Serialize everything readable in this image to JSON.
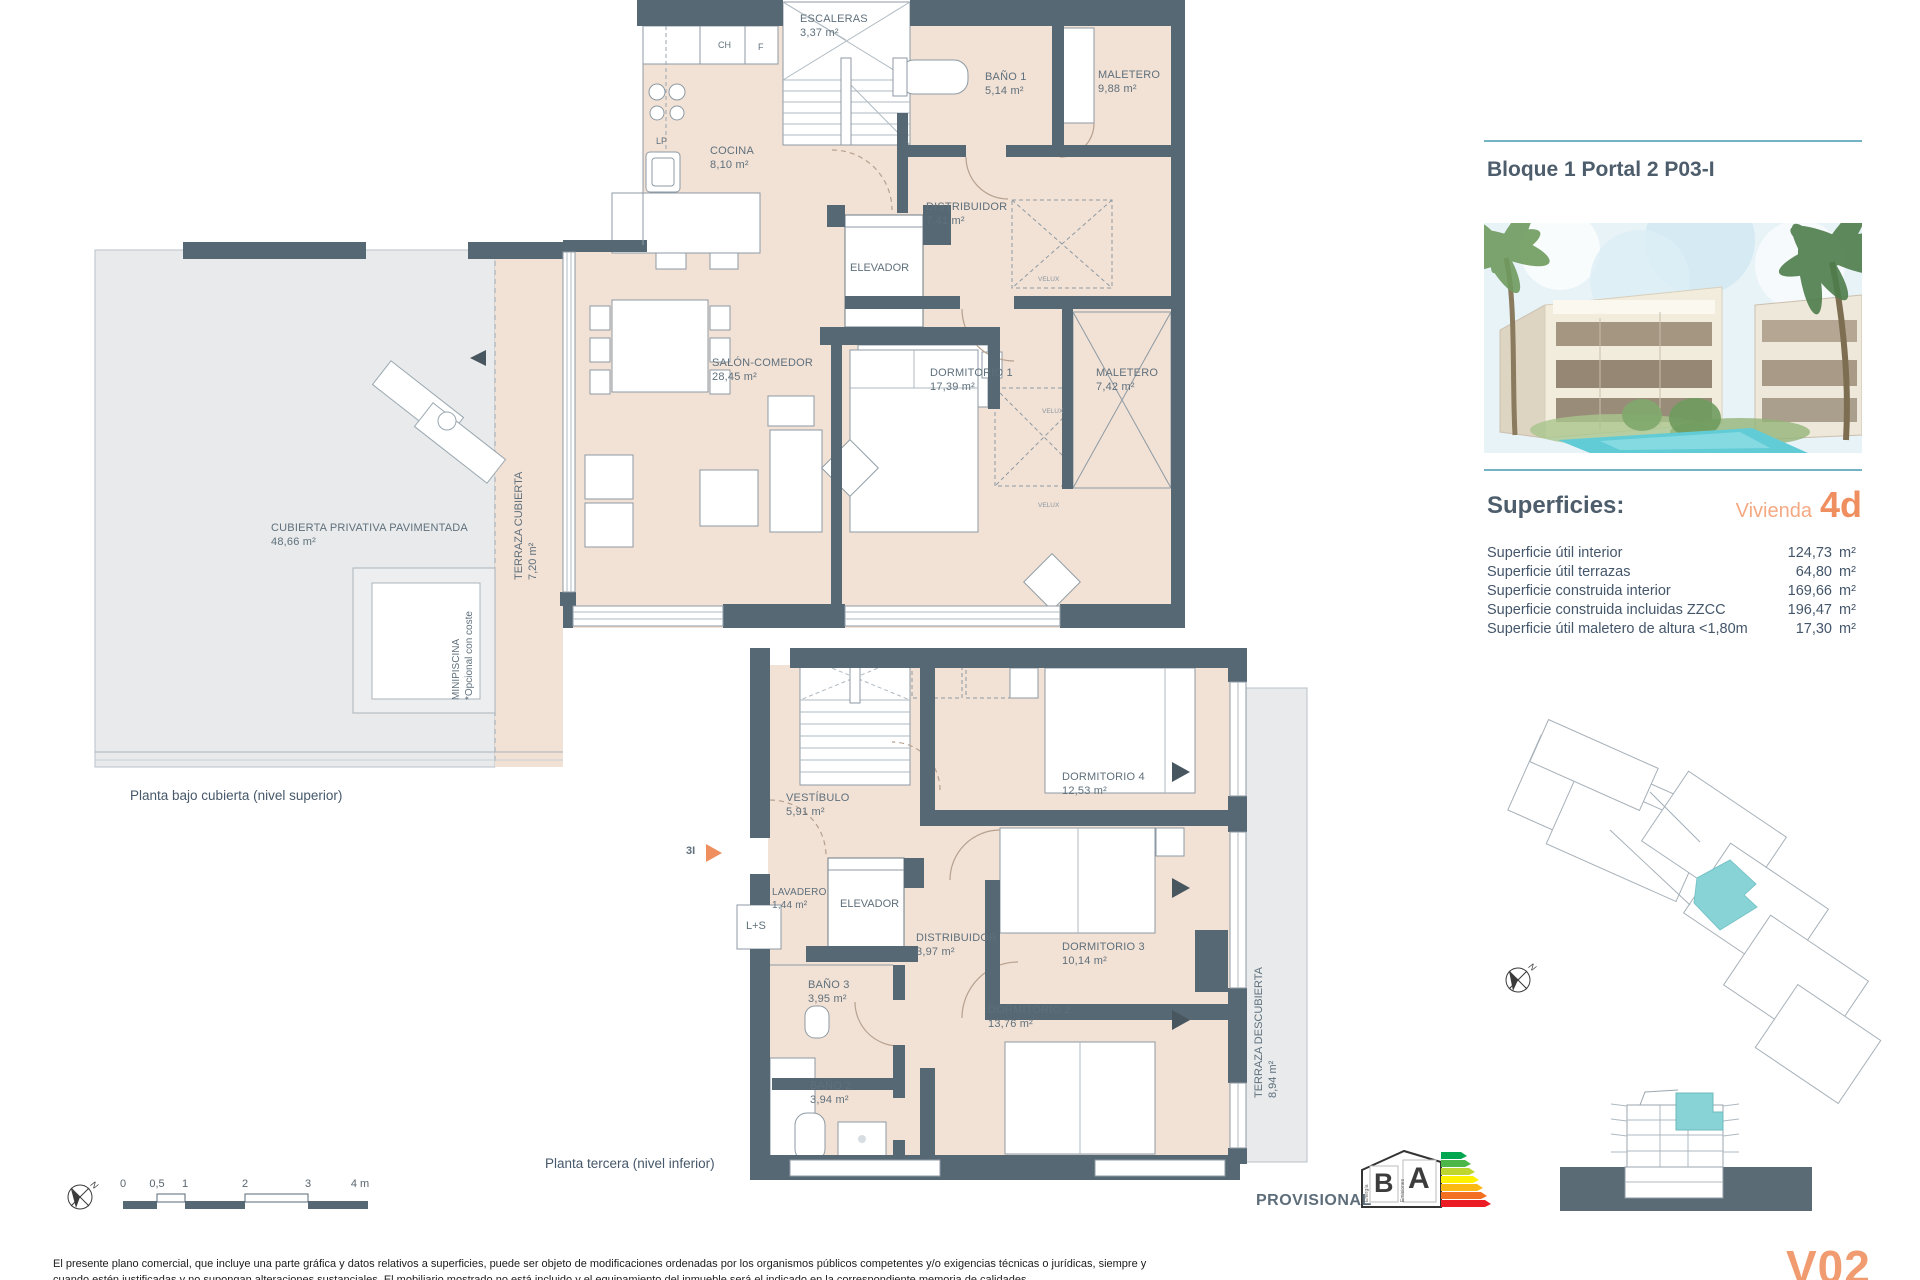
{
  "document": {
    "title": "Bloque 1 Portal 2 P03-I",
    "version": "V02",
    "provisional": "PROVISIONAL",
    "compass_n": "N"
  },
  "upper_plan": {
    "caption": "Planta bajo cubierta (nivel superior)",
    "rooms": {
      "escaleras": {
        "name": "ESCALERAS",
        "area": "3,37 m²"
      },
      "bano1": {
        "name": "BAÑO 1",
        "area": "5,14 m²"
      },
      "maletero1": {
        "name": "MALETERO",
        "area": "9,88 m²"
      },
      "cocina": {
        "name": "COCINA",
        "area": "8,10 m²"
      },
      "distribuidor": {
        "name": "DISTRIBUIDOR",
        "area": "7,41 m²"
      },
      "elevador": {
        "name": "ELEVADOR"
      },
      "salon": {
        "name": "SALÓN-COMEDOR",
        "area": "28,45 m²"
      },
      "dormitorio1": {
        "name": "DORMITORIO 1",
        "area": "17,39 m²"
      },
      "maletero2": {
        "name": "MALETERO",
        "area": "7,42 m²"
      },
      "terraza_cubierta": {
        "name": "TERRAZA CUBIERTA",
        "area": "7,20 m²"
      },
      "cubierta": {
        "name": "CUBIERTA PRIVATIVA PAVIMENTADA",
        "area": "48,66 m²"
      },
      "minipiscina": {
        "name": "MINIPISCINA",
        "note": "*Opcional con coste"
      }
    },
    "small_labels": {
      "ch": "CH",
      "f": "F",
      "lp": "LP",
      "velux": "VELUX"
    }
  },
  "lower_plan": {
    "caption": "Planta tercera (nivel inferior)",
    "entry": "3I",
    "rooms": {
      "vestibulo": {
        "name": "VESTÍBULO",
        "area": "5,91 m²"
      },
      "dormitorio4": {
        "name": "DORMITORIO 4",
        "area": "12,53 m²"
      },
      "lavadero": {
        "name": "LAVADERO",
        "area": "1,44 m²"
      },
      "ls": {
        "name": "L+S"
      },
      "elevador": {
        "name": "ELEVADOR"
      },
      "distribuidor": {
        "name": "DISTRIBUIDOR",
        "area": "3,97 m²"
      },
      "dormitorio3": {
        "name": "DORMITORIO 3",
        "area": "10,14 m²"
      },
      "bano3": {
        "name": "BAÑO 3",
        "area": "3,95 m²"
      },
      "dormitorio2": {
        "name": "DORMITORIO 2",
        "area": "13,76 m²"
      },
      "bano2": {
        "name": "BAÑO 2",
        "area": "3,94 m²"
      },
      "terraza_descubierta": {
        "name": "TERRAZA DESCUBIERTA",
        "area": "8,94 m²"
      }
    }
  },
  "panel": {
    "superficies_title": "Superficies:",
    "vivienda_label": "Vivienda",
    "vivienda_code": "4d",
    "rows": [
      {
        "label": "Superficie útil interior",
        "value": "124,73",
        "unit": "m²"
      },
      {
        "label": "Superficie útil terrazas",
        "value": "64,80",
        "unit": "m²"
      },
      {
        "label": "Superficie construida interior",
        "value": "169,66",
        "unit": "m²"
      },
      {
        "label": "Superficie construida incluidas ZZCC",
        "value": "196,47",
        "unit": "m²"
      },
      {
        "label": "Superficie útil maletero de altura <1,80m",
        "value": "17,30",
        "unit": "m²"
      }
    ]
  },
  "scale_bar": {
    "ticks": [
      "0",
      "0,5",
      "1",
      "2",
      "3",
      "4 m"
    ]
  },
  "energy_label": {
    "b": "B",
    "a": "A",
    "energia": "Energía",
    "emisiones": "Emisiones"
  },
  "footer": {
    "line1": "El presente plano comercial, que incluye una parte gráfica y datos relativos a superficies, puede ser objeto de modificaciones ordenadas por los organismos públicos competentes y/o exigencias técnicas o jurídicas, siempre y",
    "line2": "cuando estén justificadas y no supongan alteraciones sustanciales. El mobiliario mostrado no está incluido y el equipamiento del inmueble será el indicado en la correspondiente memoria de calidades."
  },
  "colors": {
    "wall": "#566874",
    "interior": "#f2e1d5",
    "terrace_gray": "#e8eaeb",
    "accent_teal": "#87d3d6",
    "accent_orange": "#ef8f5f",
    "heading": "#4d5d6c"
  }
}
